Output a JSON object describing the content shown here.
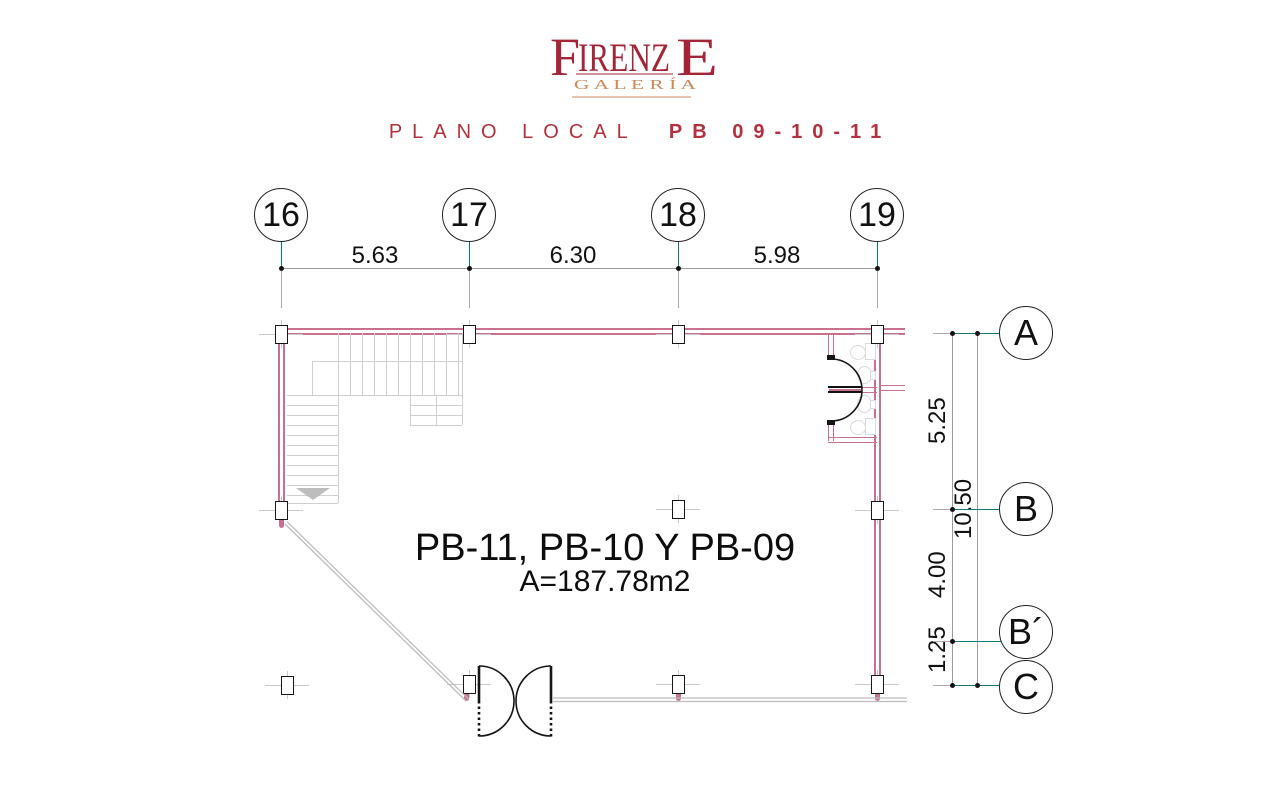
{
  "header": {
    "logo_f": "F",
    "logo_irenz": "IRENZ",
    "logo_e": "E",
    "logo_galeria": "G A L E R Í A",
    "title_plano": "PLANO LOCAL",
    "title_pb": "PB 09-10-11"
  },
  "plan_label": {
    "line1": "PB-11, PB-10 Y PB-09",
    "area": "A=187.78m2"
  },
  "grid_bubbles_top": [
    {
      "label": "16"
    },
    {
      "label": "17"
    },
    {
      "label": "18"
    },
    {
      "label": "19"
    }
  ],
  "grid_bubbles_side": [
    {
      "label": "A"
    },
    {
      "label": "B"
    },
    {
      "label": "B´"
    },
    {
      "label": "C"
    }
  ],
  "dimensions_top": [
    {
      "value": "5.63"
    },
    {
      "value": "6.30"
    },
    {
      "value": "5.98"
    }
  ],
  "dimensions_side": [
    {
      "value": "5.25"
    },
    {
      "value": "10.50"
    },
    {
      "value": "4.00"
    },
    {
      "value": "1.25"
    }
  ],
  "colors": {
    "logo_red": "#a32638",
    "galeria_orange": "#c98a5e",
    "title_red": "#b3303c",
    "wall_pink": "#c9718c",
    "axis_teal": "#0f7878",
    "dim_gray": "#9c9c9c",
    "ink": "#1a1a1a"
  }
}
